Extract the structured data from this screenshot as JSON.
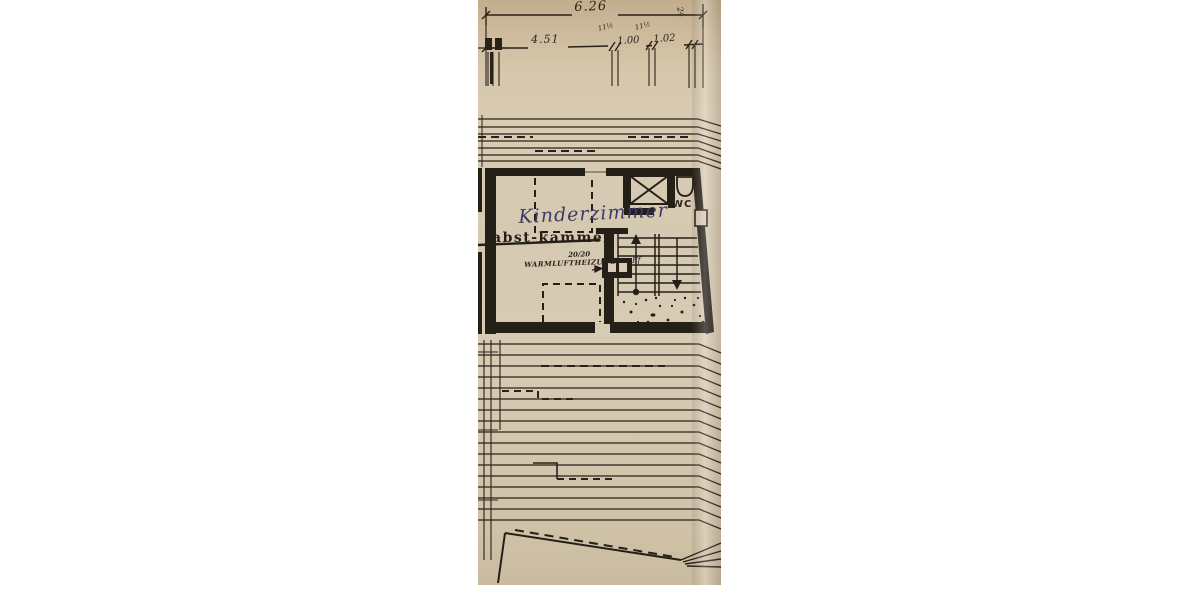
{
  "scan": {
    "description": "scanned-hand-drawn-floor-plan",
    "colors": {
      "page_bg": "#ffffff",
      "paper": "#d6c9b1",
      "paper_dark": "#c2ad8d",
      "ink": "#2a2119",
      "pen_blue": "#3c3c68"
    },
    "dimensions": {
      "total": "6.26",
      "seg_main": "4.51",
      "seg_mid": "1.00",
      "seg_right": "1.02",
      "wall_mark_1": "11½",
      "wall_mark_2": "11½",
      "wall_mark_3": "24"
    },
    "labels": {
      "room_new": "Kinderzimmer",
      "room_old": "abst-kammer",
      "wc": "WC",
      "heat_size": "20/20",
      "heat_name": "WARMLUFTHEIZUNG",
      "stair_note": "Ff"
    }
  }
}
